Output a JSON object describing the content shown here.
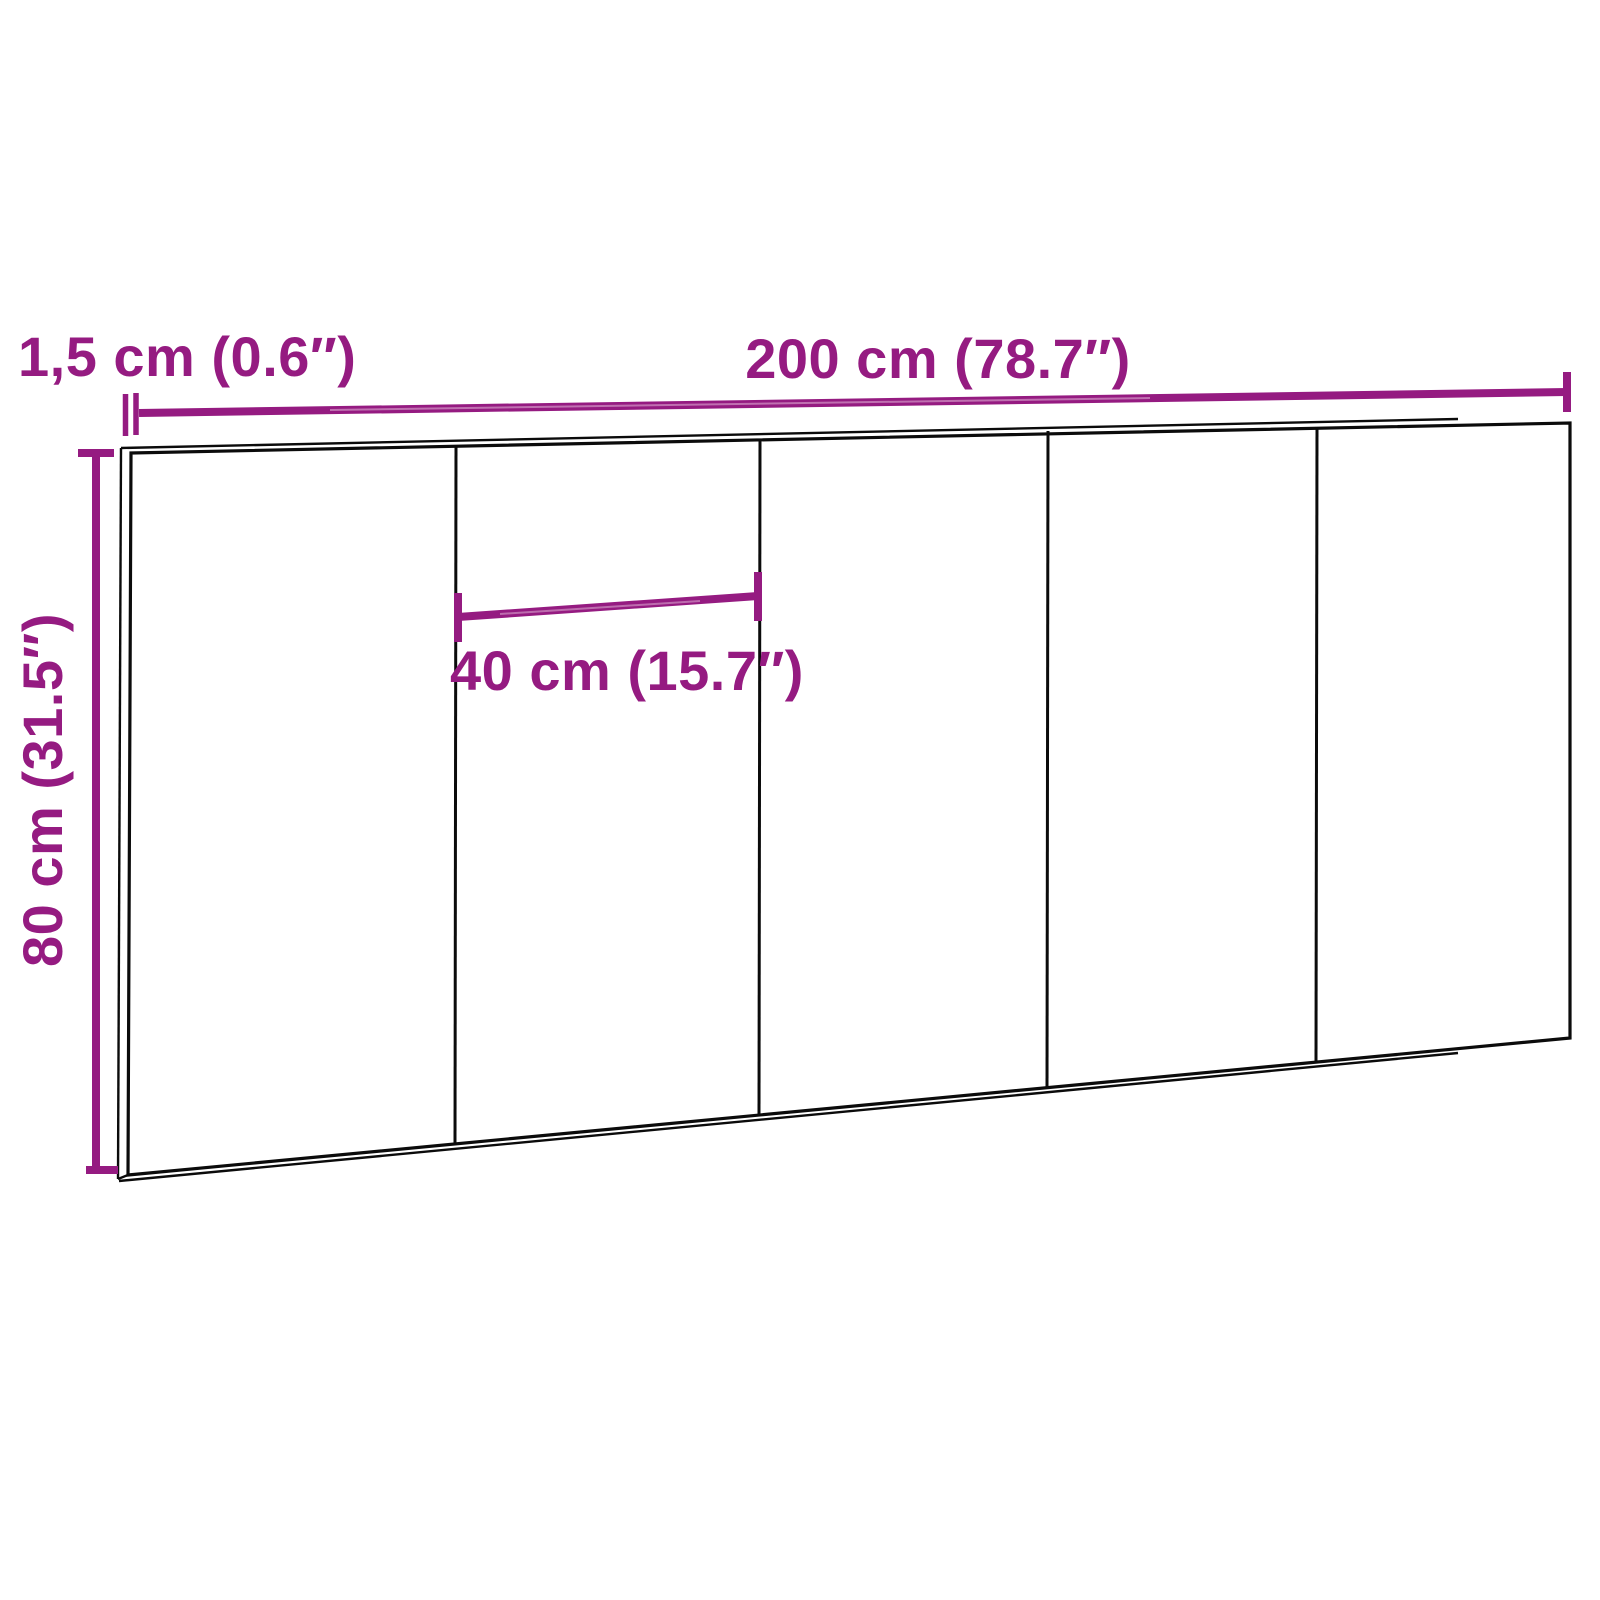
{
  "diagram": {
    "panel_count": 5,
    "colors": {
      "dimension_accent": "#951b81",
      "outline_black": "#0b0b0b",
      "background": "#ffffff"
    },
    "labels": {
      "thickness": "1,5 cm (0.6″)",
      "total_width": "200 cm (78.7″)",
      "panel_width": "40 cm (15.7″)",
      "height": "80 cm (31.5″)"
    }
  }
}
